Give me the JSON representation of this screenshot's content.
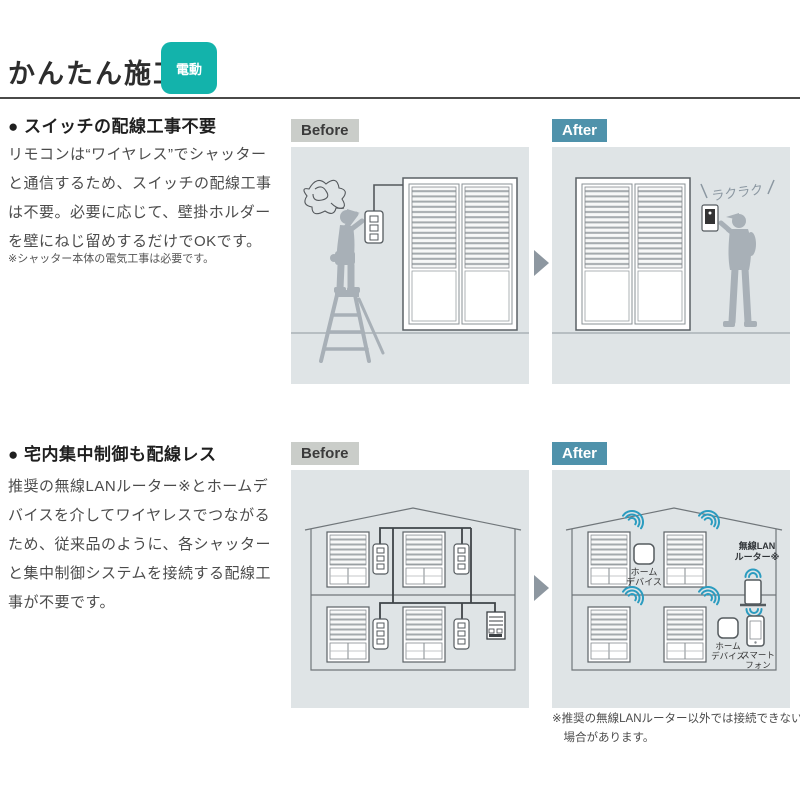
{
  "header": {
    "title": "かんたん施工",
    "badge": "電動"
  },
  "section1": {
    "heading": "● スイッチの配線工事不要",
    "body": "リモコンは“ワイヤレス”でシャッターと通信するため、スイッチの配線工事は不要。必要に応じて、壁掛ホルダーを壁にねじ留めするだけでOKです。",
    "note": "※シャッター本体の電気工事は必要です。",
    "before_label": "Before",
    "after_label": "After",
    "easy_annotation": "ラクラク"
  },
  "section2": {
    "heading": "● 宅内集中制御も配線レス",
    "body": "推奨の無線LANルーター※とホームデバイスを介してワイヤレスでつながるため、従来品のように、各シャッターと集中制御システムを接続する配線工事が不要です。",
    "before_label": "Before",
    "after_label": "After",
    "footnote": "※推奨の無線LANルーター以外では接続できない場合があります。",
    "labels": {
      "home_device_line1": "ホーム",
      "home_device_line2": "デバイス",
      "router_line1": "無線LAN",
      "router_line2": "ルーター※",
      "smartphone_line1": "スマート",
      "smartphone_line2": "フォン"
    }
  },
  "colors": {
    "badge_teal": "#13b3ab",
    "after_label_bg": "#4f92ab",
    "before_label_bg": "#cacdc9",
    "panel_bg": "#dfe4e6",
    "wifi_teal": "#2b9cc0",
    "silhouette_grey": "#a8b0b7",
    "arrow_grey": "#8d97a0"
  }
}
